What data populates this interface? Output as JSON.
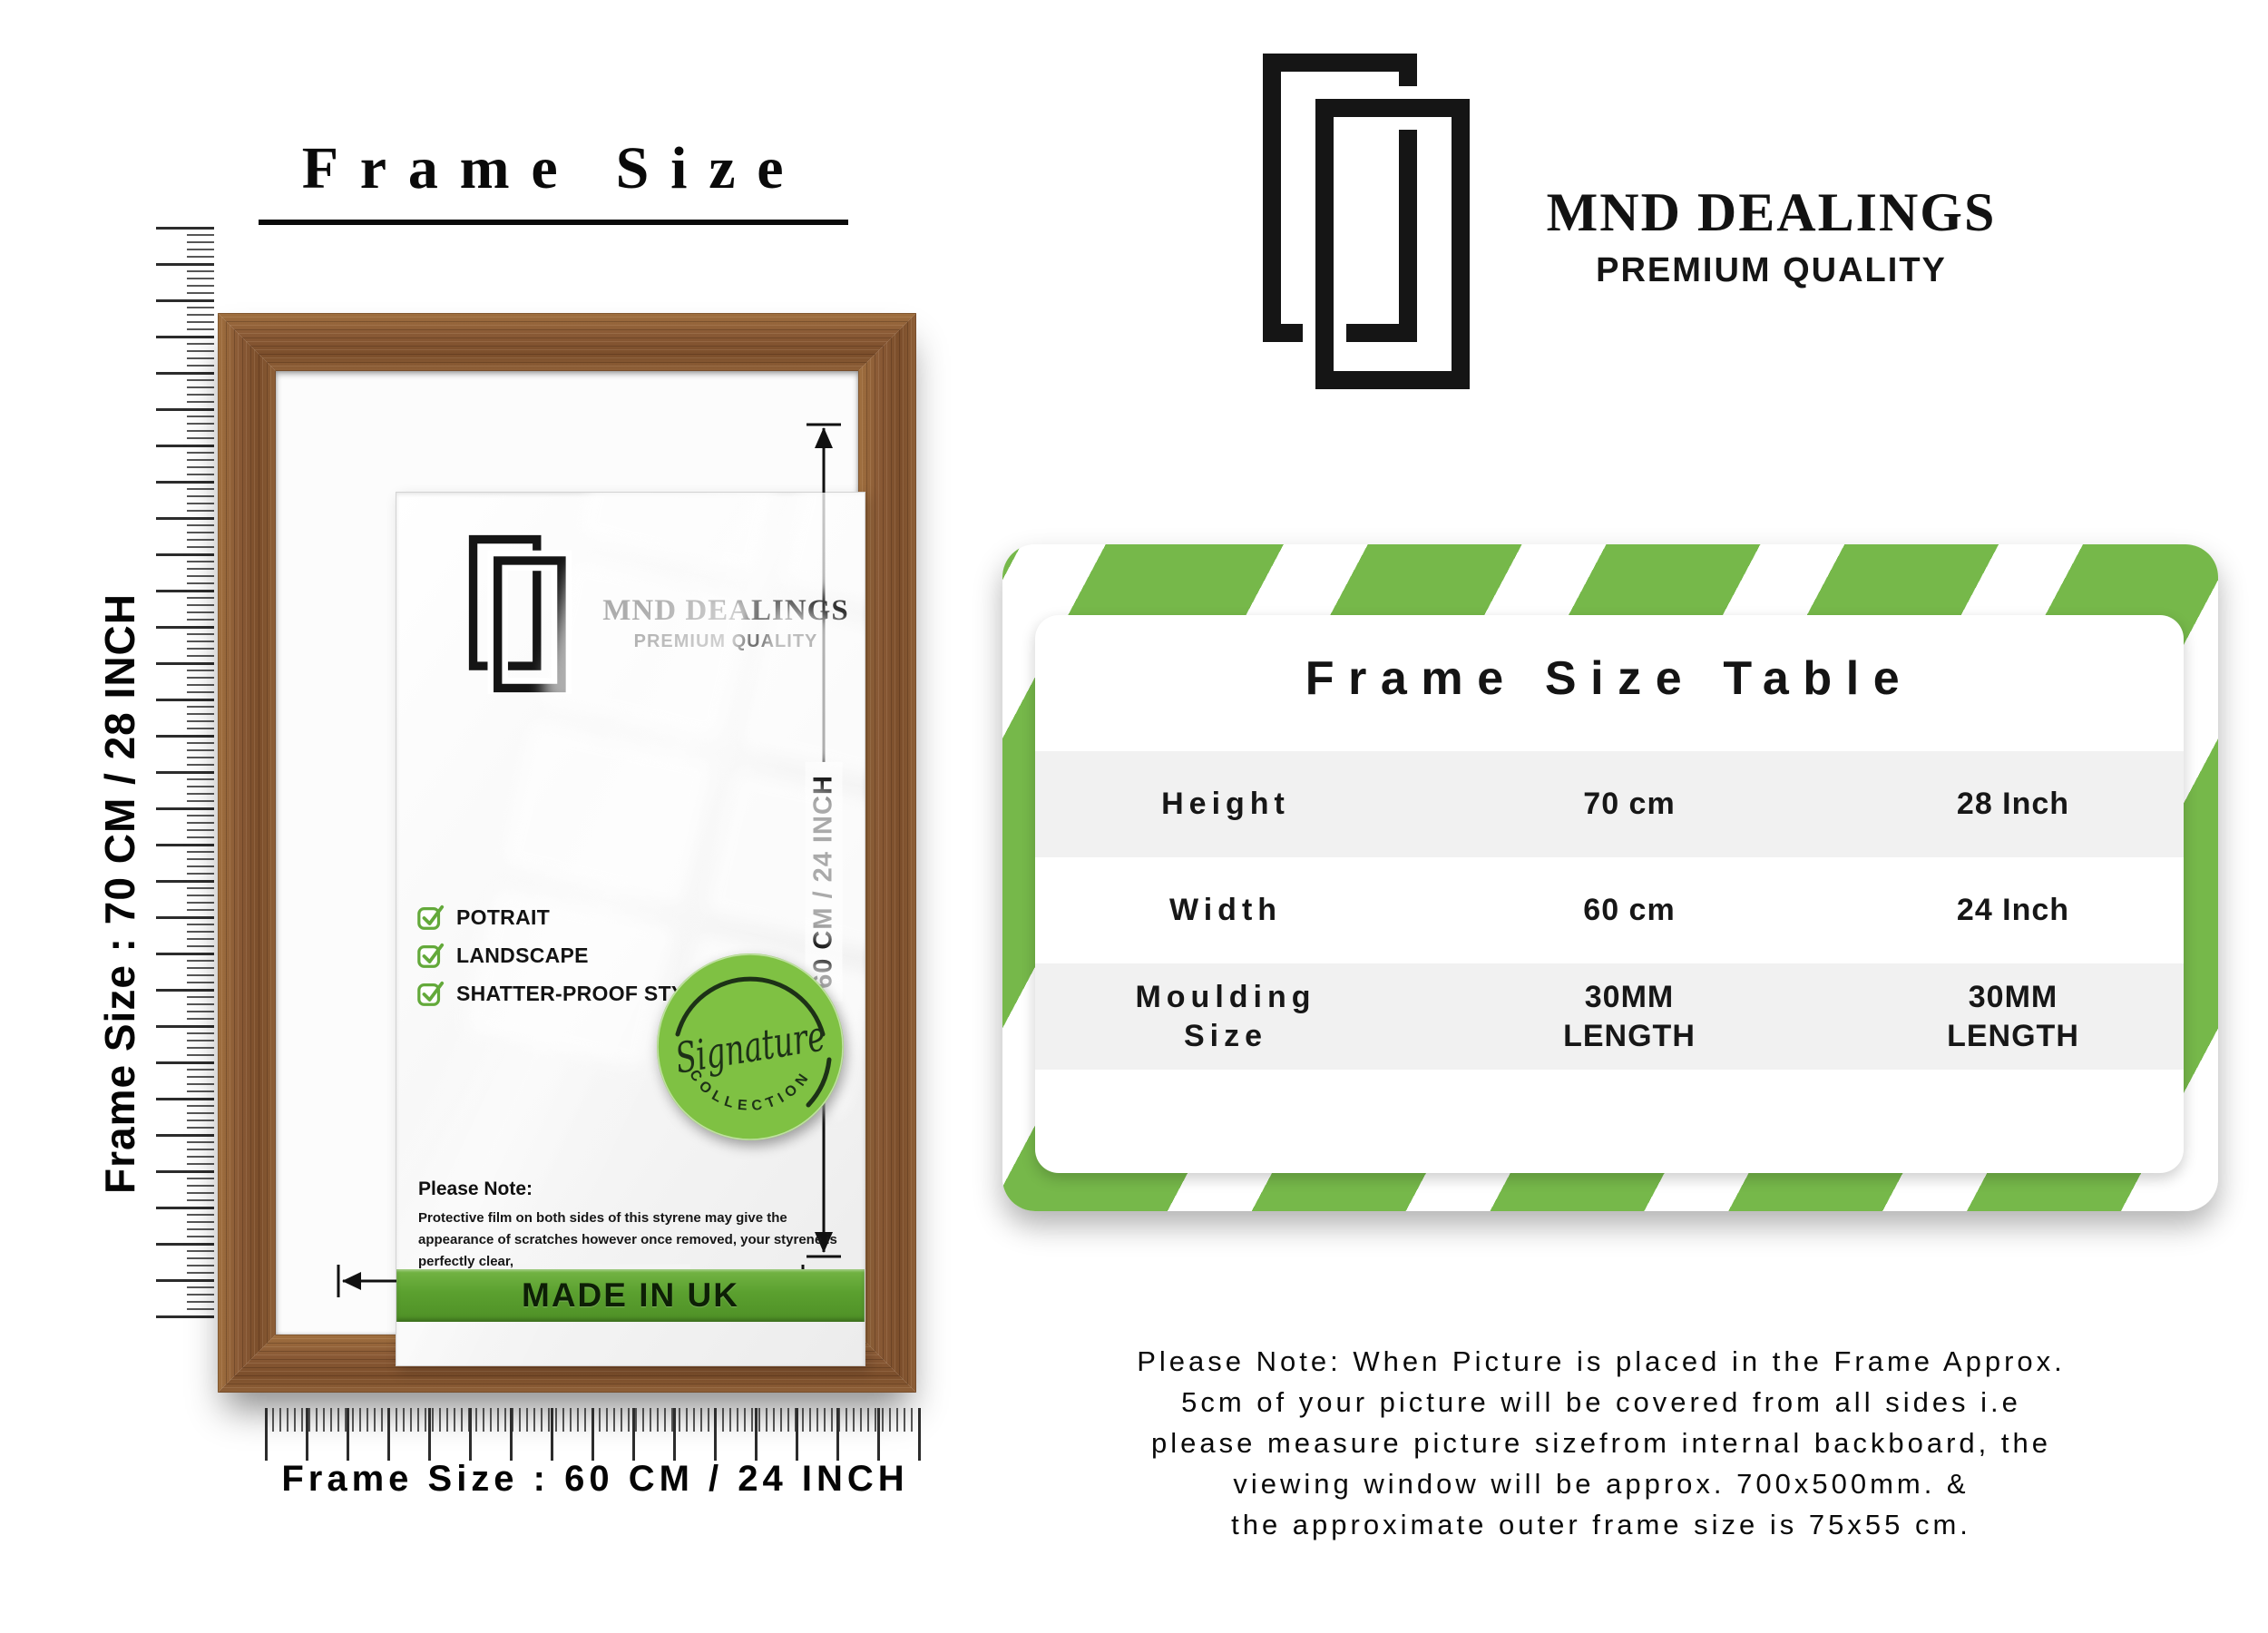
{
  "title": "Frame Size",
  "brand": {
    "name": "MND DEALINGS",
    "tagline": "PREMIUM QUALITY"
  },
  "frame": {
    "checklist": [
      "POTRAIT",
      "LANDSCAPE",
      "SHATTER-PROOF STYRENE"
    ],
    "badge": {
      "script": "Signature",
      "arc": "COLLECTION"
    },
    "note_title": "Please Note:",
    "note_body": "Protective film on both sides of this styrene may give the appearance of scratches however once removed, your styrene is perfectly clear,",
    "made_in": "MADE IN UK",
    "width_dim": "50 CM / 20 INCH",
    "height_dim": "60 CM / 24 INCH"
  },
  "rulers": {
    "left_label": "Frame Size : 70 CM / 28 INCH",
    "bottom_label": "Frame Size : 60 CM / 24 INCH"
  },
  "size_table": {
    "title": "Frame Size Table",
    "rows": [
      {
        "label": "Height",
        "cm": "70 cm",
        "inch": "28 Inch"
      },
      {
        "label": "Width",
        "cm": "60 cm",
        "inch": "24 Inch"
      },
      {
        "label": "Moulding\nSize",
        "cm": "30MM\nLENGTH",
        "inch": "30MM\nLENGTH"
      }
    ]
  },
  "footnote": {
    "lines": [
      "Please Note: When Picture is placed in the Frame Approx.",
      "5cm of your picture will be covered from all sides i.e",
      "please measure picture sizefrom internal backboard, the",
      "viewing window will be approx. 700x500mm. &",
      "the approximate outer frame size is 75x55 cm."
    ]
  },
  "colors": {
    "green": "#76b84a",
    "green_dark": "#4e9026",
    "badge_green": "#7fc143",
    "check_green": "#63a93a",
    "wood": "#8a5a36",
    "band_gray": "#f1f1f1",
    "ink": "#111111"
  }
}
